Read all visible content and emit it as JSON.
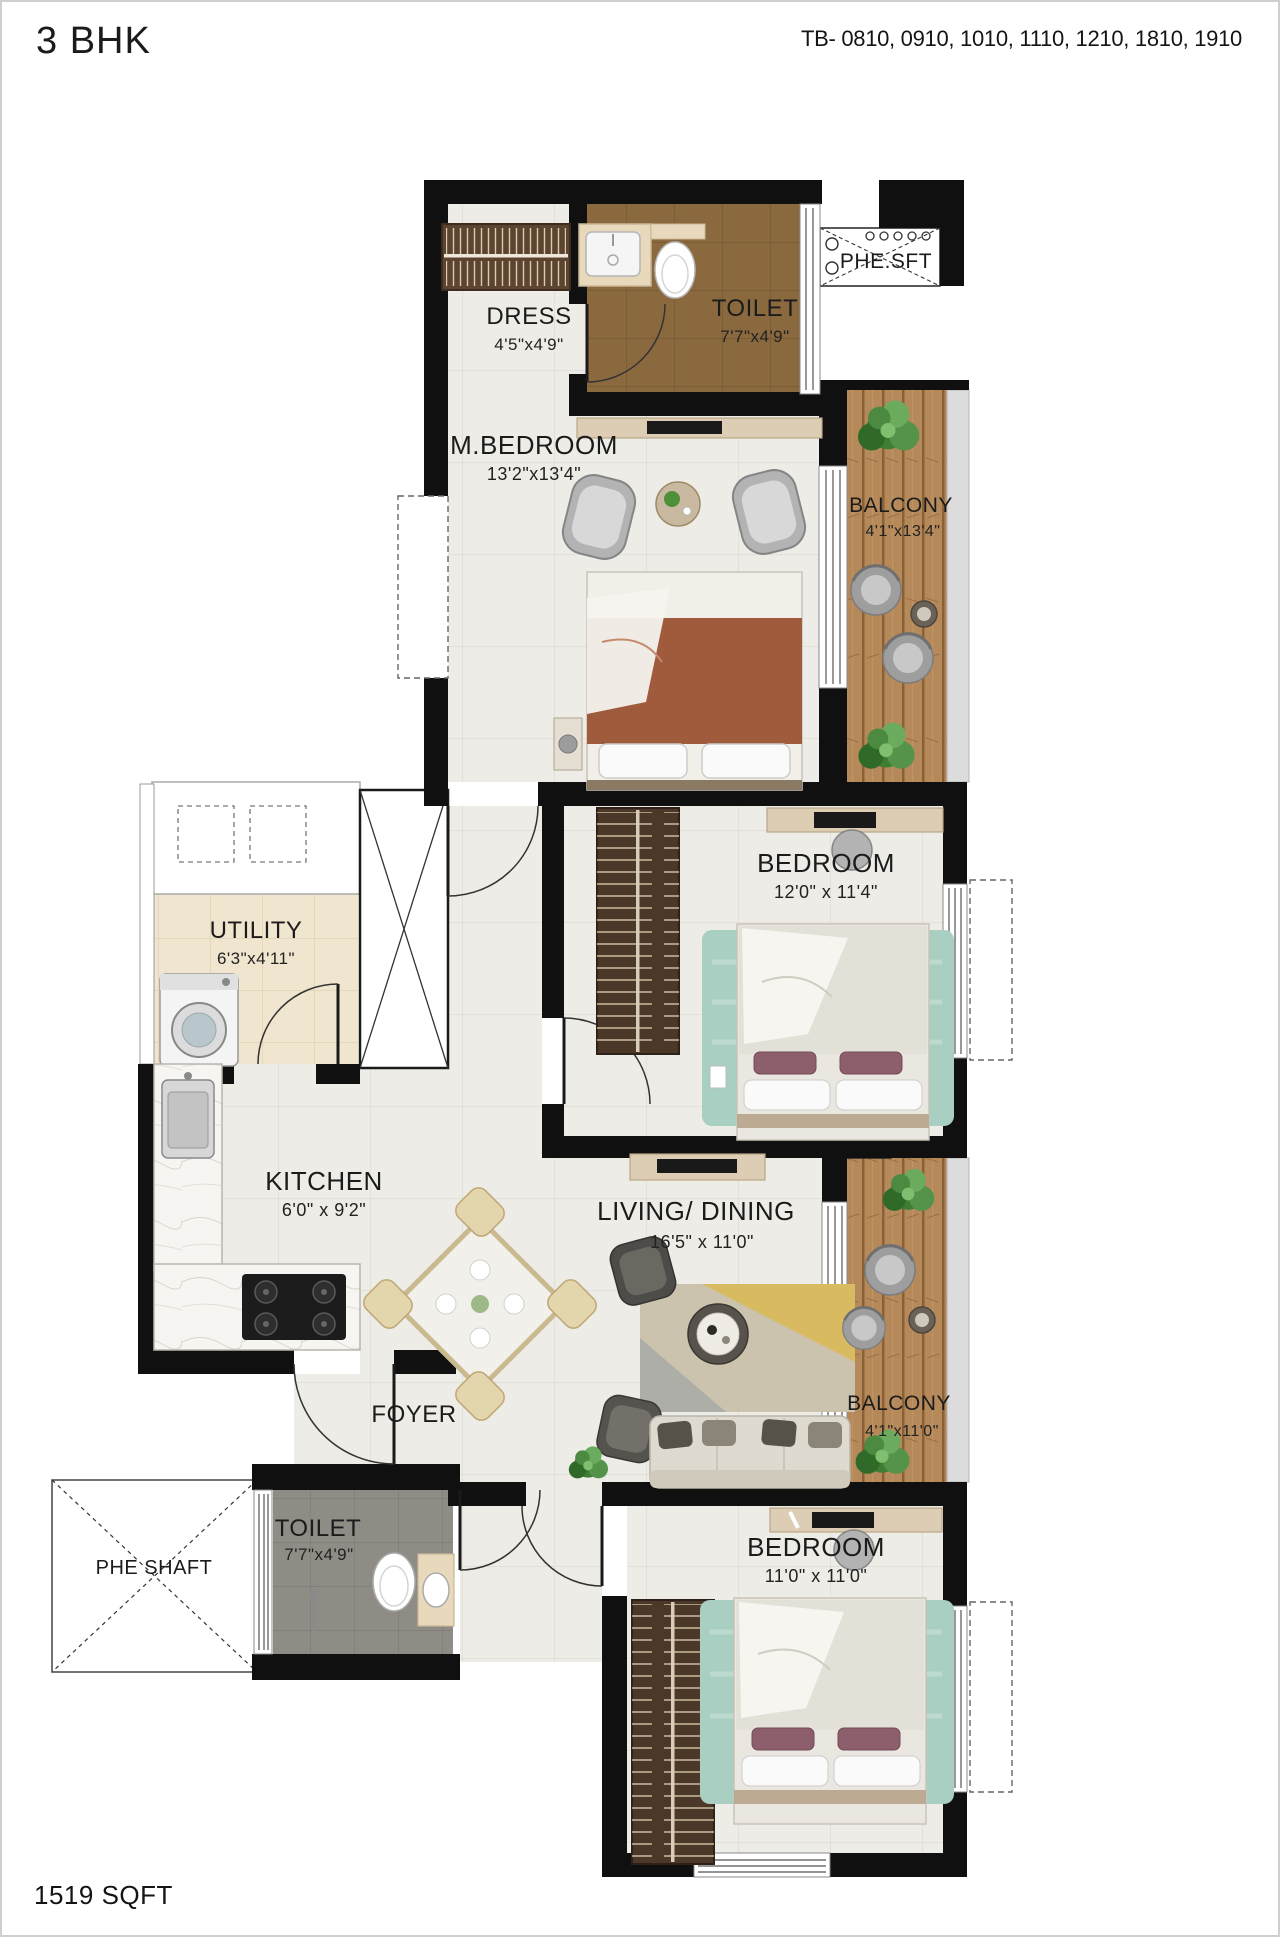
{
  "header": {
    "title": "3 BHK",
    "units": "TB- 0810, 0910, 1010, 1110, 1210, 1810, 1910"
  },
  "footer": {
    "area": "1519 SQFT"
  },
  "rooms": {
    "dress": {
      "name": "DRESS",
      "dim": "4'5\"x4'9\""
    },
    "toilet_top": {
      "name": "TOILET",
      "dim": "7'7\"x4'9\""
    },
    "phe_sft": {
      "name": "PHE.SFT"
    },
    "m_bedroom": {
      "name": "M.BEDROOM",
      "dim": "13'2\"x13'4\""
    },
    "balcony_top": {
      "name": "BALCONY",
      "dim": "4'1\"x13'4\""
    },
    "bedroom_mid": {
      "name": "BEDROOM",
      "dim": "12'0\" x 11'4\""
    },
    "utility": {
      "name": "UTILITY",
      "dim": "6'3\"x4'11\""
    },
    "kitchen": {
      "name": "KITCHEN",
      "dim": "6'0\" x 9'2\""
    },
    "living_dining": {
      "name": "LIVING/ DINING",
      "dim": "16'5\" x 11'0\""
    },
    "balcony_mid": {
      "name": "BALCONY",
      "dim": "4'1\"x11'0\""
    },
    "foyer": {
      "name": "FOYER"
    },
    "phe_shaft": {
      "name": "PHE SHAFT"
    },
    "toilet_bottom": {
      "name": "TOILET",
      "dim": "7'7\"x4'9\""
    },
    "bedroom_bottom": {
      "name": "BEDROOM",
      "dim": "11'0\" x 11'0\""
    }
  },
  "colors": {
    "wall": "#101010",
    "tile_light": "#edece6",
    "tile_brown": "#8a693f",
    "tile_gray": "#8f8c85",
    "tile_beige": "#f0e5cf",
    "balcony_wood": "#b5895a",
    "rug_teal": "#a9cfc2",
    "master_bed_blanket": "#a05a3c",
    "wardrobe": "#4b3829"
  }
}
